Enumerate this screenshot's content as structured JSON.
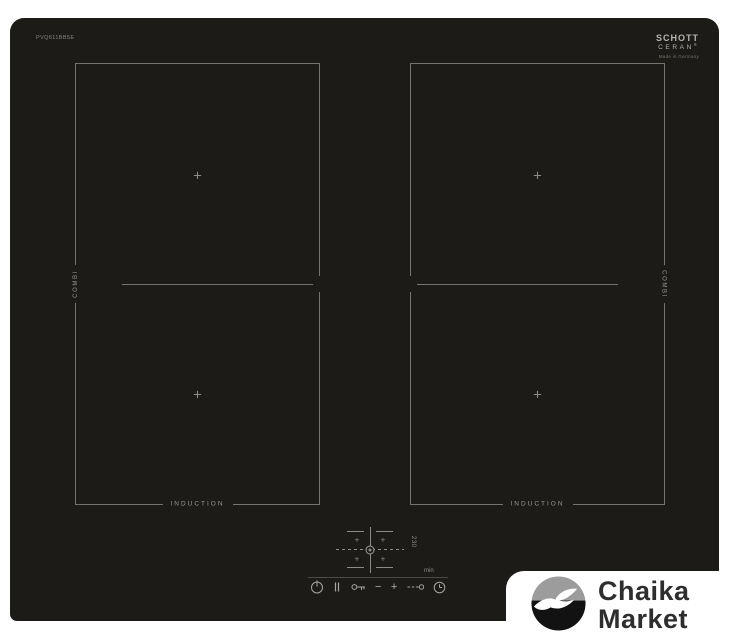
{
  "cooktop": {
    "model": "PVQ611BB5E",
    "brand": {
      "line1": "SCHOTT",
      "line2": "CERAN",
      "registered": "®",
      "subtext": "Made in Germany"
    },
    "zones": {
      "plus_mark": "+",
      "left": {
        "side_label": "COMBI",
        "bottom_label": "INDUCTION"
      },
      "right": {
        "side_label": "COMBI",
        "bottom_label": "INDUCTION"
      }
    },
    "controls": {
      "selector_plus": "+",
      "marking": "230",
      "min_label": "min",
      "minus_label": "−",
      "plus_label": "+",
      "icons": [
        "power-icon",
        "pause-icon",
        "key-lock-icon",
        "minus-button",
        "plus-button",
        "timer-select-icon",
        "clock-icon"
      ]
    },
    "colors": {
      "surface": "#1c1b18",
      "line": "#75756f",
      "label": "#96968f"
    }
  },
  "watermark": {
    "line1": "Chaika",
    "line2": "Market",
    "circle_top_color": "#9c9c9c",
    "circle_bottom_color": "#121212"
  }
}
